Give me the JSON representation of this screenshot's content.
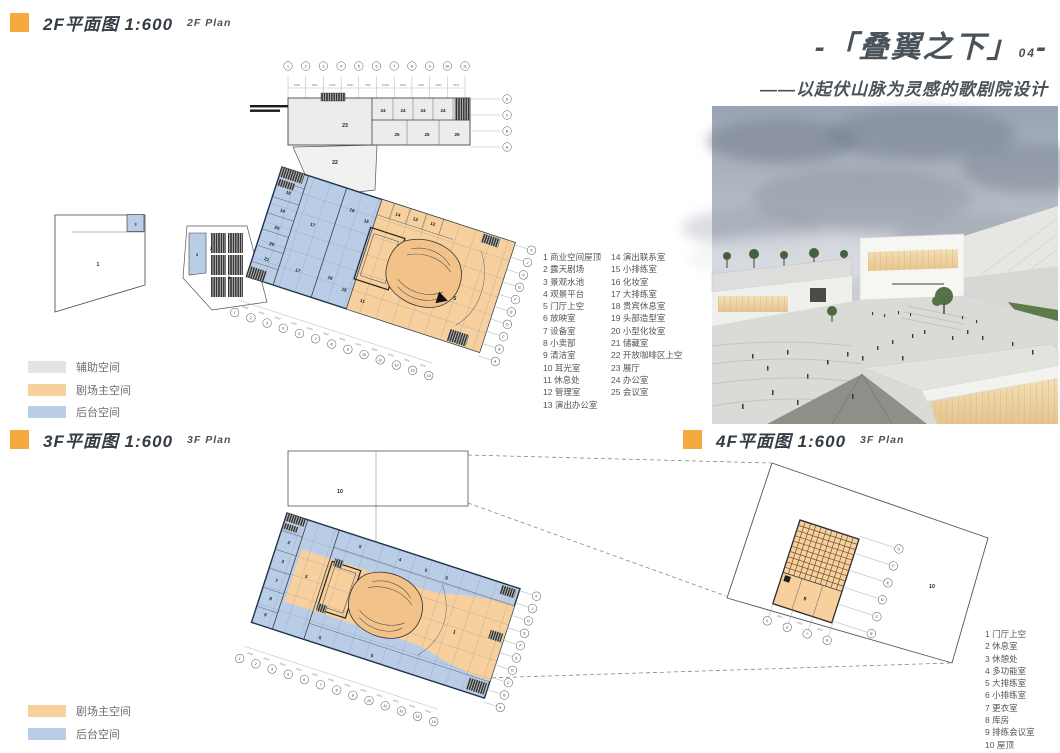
{
  "sections": {
    "plan2f": {
      "title": "2F平面图  1:600",
      "subtitle": "2F  Plan"
    },
    "plan3f": {
      "title": "3F平面图  1:600",
      "subtitle": "3F  Plan"
    },
    "plan4f": {
      "title": "4F平面图  1:600",
      "subtitle": "3F  Plan"
    }
  },
  "title_block": {
    "line1_prefix": "-「叠翼之下」",
    "number": "04",
    "line1_suffix": "-",
    "subtitle": "——以起伏山脉为灵感的歌剧院设计"
  },
  "colors": {
    "accent_orange": "#F5A93F",
    "title_gray": "#4A525A",
    "plan_orange": "#F8D09E",
    "plan_blue": "#B9CDE6",
    "plan_gray": "#E3E3E3"
  },
  "legend_2f": {
    "aux": "辅助空间",
    "main": "剧场主空间",
    "backstage": "后台空间"
  },
  "legend_3f": {
    "main": "剧场主空间",
    "backstage": "后台空间"
  },
  "room_list_2f": {
    "col1": [
      "1 商业空间屋顶",
      "2 露天剧场",
      "3 景观水池",
      "4 观景平台",
      "5 门厅上空",
      "6 放映室",
      "7 设备室",
      "8 小卖部",
      "9 清洁室",
      "10 耳光室",
      "11 休息处",
      "12 管理室",
      "13 演出办公室"
    ],
    "col2": [
      "14 演出联系室",
      "15 小排练室",
      "16 化妆室",
      "17 大排练室",
      "18 贵宾休息室",
      "19 头部造型室",
      "20 小型化妆室",
      "21 储藏室",
      "22 开放咖啡区上空",
      "23 展厅",
      "24 办公室",
      "25 会议室"
    ]
  },
  "room_list_4f": [
    "1 门厅上空",
    "2 休息室",
    "3 休憩处",
    "4 多功能室",
    "5 大排练室",
    "6 小排练室",
    "7 更衣室",
    "8 库房",
    "9 排练会议室",
    "10 屋顶"
  ],
  "plan2f": {
    "top_bubbles_cfg": {
      "x0": 273,
      "y0": 16,
      "dx": 17.7,
      "dy": 0,
      "r": 4.3,
      "items": [
        "1",
        "2",
        "3",
        "4",
        "5",
        "6",
        "7",
        "8",
        "9",
        "10",
        "11"
      ]
    },
    "top_dims": {
      "x0": 282,
      "y0": 36,
      "dx": 17.7,
      "items": [
        "8400",
        "8400",
        "8400",
        "8400",
        "7800",
        "11300",
        "8400",
        "8400",
        "8400",
        "8400"
      ]
    },
    "right_bubbles_cfg": {
      "x0": 492,
      "y0": 49,
      "dx": 0,
      "dy": 16,
      "r": 4.3,
      "items": [
        "D",
        "C",
        "B",
        "A"
      ]
    },
    "bottom_bubbles_cfg": {
      "x0": 0,
      "y0": 153,
      "dx": 17,
      "dy": 0,
      "r": 4.3,
      "items": [
        "1",
        "2",
        "3",
        "5",
        "6",
        "7",
        "8",
        "9",
        "10",
        "11",
        "12",
        "13",
        "14"
      ]
    },
    "bottom_dims": {
      "x0": 8.5,
      "y0": 146,
      "dx": 17,
      "items": [
        "8400",
        "8400",
        "8400",
        "8400",
        "8400",
        "8400",
        "8400",
        "8400",
        "8400",
        "8400",
        "8400",
        "8400"
      ]
    },
    "edge_bubbles_cfg": {
      "x0": 263,
      "y0": 2,
      "dx": 0,
      "dy": 13,
      "r": 4.3,
      "items": [
        "K",
        "J",
        "H",
        "G",
        "F",
        "E",
        "D",
        "C",
        "B",
        "A"
      ]
    },
    "wing_labels": [
      {
        "t": "23",
        "x": 330,
        "y": 77,
        "s": 5.2
      },
      {
        "t": "24",
        "x": 368,
        "y": 62
      },
      {
        "t": "24",
        "x": 388,
        "y": 62
      },
      {
        "t": "24",
        "x": 408,
        "y": 62
      },
      {
        "t": "24",
        "x": 428,
        "y": 62
      },
      {
        "t": "25",
        "x": 382,
        "y": 86
      },
      {
        "t": "25",
        "x": 412,
        "y": 86
      },
      {
        "t": "25",
        "x": 442,
        "y": 86
      },
      {
        "t": "22",
        "x": 320,
        "y": 114,
        "s": 5.2
      },
      {
        "t": "1",
        "x": 83,
        "y": 216,
        "s": 5.2
      },
      {
        "t": "3",
        "x": 120.5,
        "y": 175.5,
        "s": 4
      },
      {
        "t": "3",
        "x": 182,
        "y": 206,
        "s": 4
      },
      {
        "t": "2",
        "x": 196,
        "y": 200,
        "s": 4
      },
      {
        "t": "4",
        "x": 214,
        "y": 229,
        "s": 4.5
      }
    ],
    "block_labels": [
      {
        "t": "18",
        "x": 14,
        "y": 24
      },
      {
        "t": "19",
        "x": 14,
        "y": 43
      },
      {
        "t": "20",
        "x": 14,
        "y": 61
      },
      {
        "t": "20",
        "x": 14,
        "y": 78
      },
      {
        "t": "21",
        "x": 14,
        "y": 94
      },
      {
        "t": "17",
        "x": 47,
        "y": 47
      },
      {
        "t": "17",
        "x": 47,
        "y": 95
      },
      {
        "t": "16",
        "x": 80,
        "y": 21
      },
      {
        "t": "15",
        "x": 97,
        "y": 27
      },
      {
        "t": "16",
        "x": 80,
        "y": 92
      },
      {
        "t": "15",
        "x": 97,
        "y": 99
      },
      {
        "t": "14",
        "x": 125,
        "y": 11
      },
      {
        "t": "13",
        "x": 143,
        "y": 10
      },
      {
        "t": "12",
        "x": 161,
        "y": 9
      },
      {
        "t": "11",
        "x": 118,
        "y": 104
      },
      {
        "t": "5",
        "x": 205,
        "y": 73,
        "s": 5.2
      }
    ]
  },
  "plan3f": {
    "misc_labels": [
      {
        "t": "10",
        "x": 125,
        "y": 50,
        "s": 5.2
      }
    ],
    "block_labels": [
      {
        "t": "2",
        "x": 11,
        "y": 29
      },
      {
        "t": "3",
        "x": 11,
        "y": 49
      },
      {
        "t": "7",
        "x": 11,
        "y": 69
      },
      {
        "t": "8",
        "x": 11,
        "y": 88
      },
      {
        "t": "9",
        "x": 11,
        "y": 105
      },
      {
        "t": "5",
        "x": 38,
        "y": 56
      },
      {
        "t": "5",
        "x": 80,
        "y": 11
      },
      {
        "t": "4",
        "x": 122,
        "y": 11
      },
      {
        "t": "5",
        "x": 150,
        "y": 13
      },
      {
        "t": "5",
        "x": 172,
        "y": 14
      },
      {
        "t": "5",
        "x": 70,
        "y": 110
      },
      {
        "t": "5",
        "x": 125,
        "y": 111
      },
      {
        "t": "1",
        "x": 196,
        "y": 63,
        "s": 5.2
      }
    ],
    "bottom_bubbles_cfg": {
      "x0": 0,
      "y0": 153,
      "dx": 17,
      "dy": 0,
      "r": 4.3,
      "items": [
        "1",
        "2",
        "3",
        "5",
        "6",
        "7",
        "8",
        "9",
        "10",
        "11",
        "12",
        "13",
        "14"
      ]
    },
    "bottom_dims": {
      "x0": 8.5,
      "y0": 146,
      "dx": 17,
      "items": [
        "8400",
        "8400",
        "8400",
        "8400",
        "8400",
        "8400",
        "8400",
        "8400",
        "8400",
        "8400",
        "8400",
        "8400"
      ]
    },
    "edge_bubbles_cfg": {
      "x0": 263,
      "y0": 2,
      "dx": 0,
      "dy": 13,
      "r": 4.3,
      "items": [
        "K",
        "J",
        "H",
        "G",
        "F",
        "E",
        "D",
        "C",
        "B",
        "A"
      ]
    }
  },
  "plan4f": {
    "misc_labels": [
      {
        "t": "10",
        "x": 717,
        "y": 145,
        "s": 5.2
      }
    ],
    "block_labels": [
      {
        "t": "9",
        "x": 29,
        "y": 75,
        "s": 5.2
      }
    ],
    "bottom_bubbles_cfg": {
      "x0": 0,
      "y0": 106,
      "dx": 21,
      "dy": 0,
      "r": 4.3,
      "items": [
        "5",
        "6",
        "7",
        "8"
      ]
    },
    "bottom_dims": {
      "x0": 10.5,
      "y0": 99,
      "dx": 21,
      "items": [
        "3950",
        "3950",
        "3950"
      ]
    },
    "edge_bubbles_cfg": {
      "x0": 103,
      "y0": -3,
      "dx": 0,
      "dy": 17.8,
      "r": 4.3,
      "items": [
        "G",
        "F",
        "E",
        "D",
        "C",
        "B"
      ]
    }
  }
}
